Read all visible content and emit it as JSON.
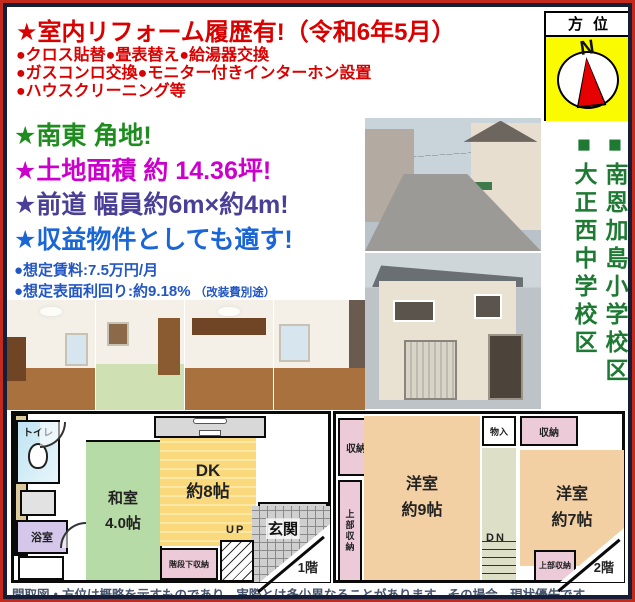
{
  "header": {
    "title": "★室内リフォーム履歴有!（令和6年5月）",
    "bullets": [
      "●クロス貼替●畳表替え●給湯器交換",
      "●ガスコンロ交換●モニター付きインターホン設置",
      "●ハウスクリーニング等"
    ],
    "accent_color": "#d90000"
  },
  "compass": {
    "label": "方位",
    "north": "N",
    "bg_color": "#fafa00",
    "needle_color": "#e60000"
  },
  "highlights": [
    {
      "text": "★南東 角地!",
      "color": "#1e8c1e"
    },
    {
      "text": "★土地面積 約 14.36坪!",
      "color": "#cc00cc"
    },
    {
      "text": "★前道 幅員約6m×約4m!",
      "color": "#4a3f96"
    },
    {
      "text": "★収益物件としても適す!",
      "color": "#1a66d6"
    }
  ],
  "income": {
    "rent": "●想定賃料:7.5万円/月",
    "yield": "●想定表面利回り:約9.18%",
    "yield_note": "（改装費別途）",
    "text_color": "#2256c4"
  },
  "school_district": {
    "line1": "■南恩加島小学校区",
    "line2": "■大正西中学校区",
    "text_color": "#1e7a33"
  },
  "floorplan1": {
    "toilet": "トイレ",
    "bath": "浴室",
    "japanese_room": "和室",
    "japanese_room_size": "4.0帖",
    "dk": "DK",
    "dk_size": "約8帖",
    "entrance": "玄関",
    "stair_storage": "階段下収納",
    "up": "UP",
    "floor_label": "1階"
  },
  "floorplan2": {
    "storage_top_left": "収納",
    "upper_storage_left": "上部収納",
    "room9": "洋室",
    "room9_size": "約9帖",
    "closet": "物入",
    "storage_top_right": "収納",
    "room7": "洋室",
    "room7_size": "約7帖",
    "dn": "DN",
    "upper_storage_right": "上部収納",
    "floor_label": "2階"
  },
  "disclaimer": "間取図・方位は概略を示すものであり、実際とは多少異なることがあります。その場合、現状優先です。"
}
